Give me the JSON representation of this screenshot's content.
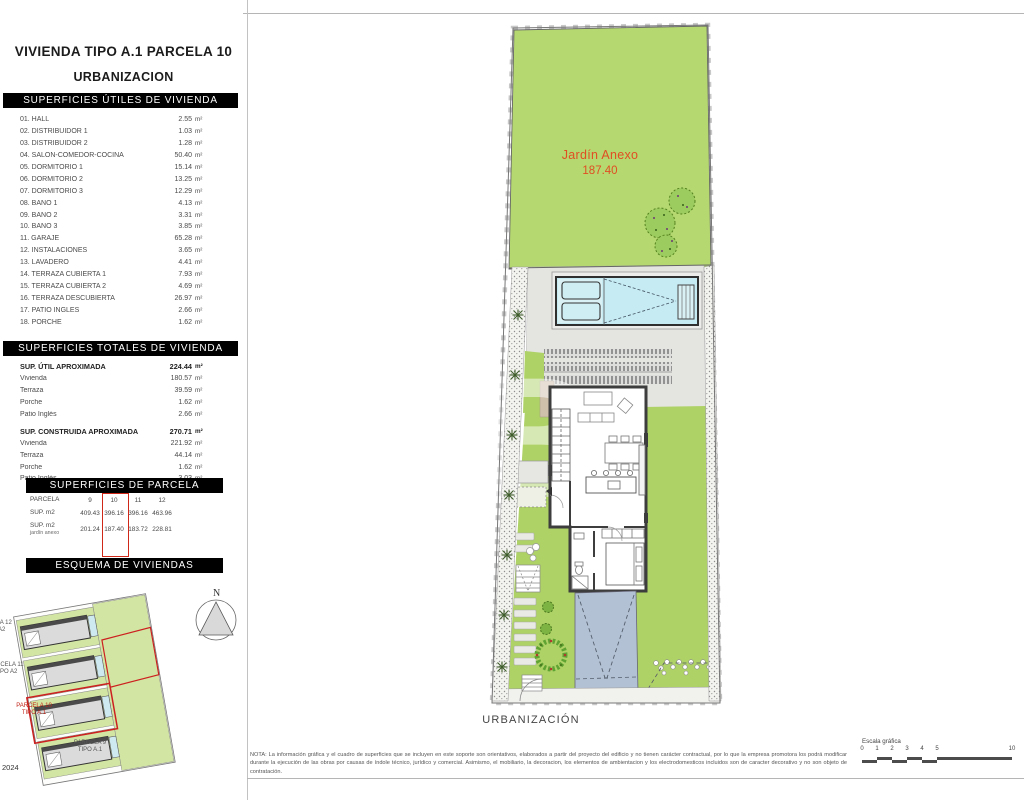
{
  "header": {
    "title_line1": "VIVIENDA TIPO A.1 PARCELA 10",
    "title_line2": "URBANIZACION"
  },
  "superficies_utiles": {
    "header": "SUPERFICIES ÚTILES DE VIVIENDA",
    "rows": [
      {
        "label": "01.  HALL",
        "value": "2.55",
        "unit": "m²"
      },
      {
        "label": "02.  DISTRIBUIDOR 1",
        "value": "1.03",
        "unit": "m²"
      },
      {
        "label": "03.  DISTRIBUIDOR 2",
        "value": "1.28",
        "unit": "m²"
      },
      {
        "label": "04.  SALÓN-COMEDOR-COCINA",
        "value": "50.40",
        "unit": "m²"
      },
      {
        "label": "05.  DORMITORIO 1",
        "value": "15.14",
        "unit": "m²"
      },
      {
        "label": "06.  DORMITORIO 2",
        "value": "13.25",
        "unit": "m²"
      },
      {
        "label": "07.  DORMITORIO 3",
        "value": "12.29",
        "unit": "m²"
      },
      {
        "label": "08.  BAÑO 1",
        "value": "4.13",
        "unit": "m²"
      },
      {
        "label": "09.  BAÑO 2",
        "value": "3.31",
        "unit": "m²"
      },
      {
        "label": "10.  BAÑO 3",
        "value": "3.85",
        "unit": "m²"
      },
      {
        "label": "11.  GARAJE",
        "value": "65.28",
        "unit": "m²"
      },
      {
        "label": "12.  INSTALACIONES",
        "value": "3.65",
        "unit": "m²"
      },
      {
        "label": "13.  LAVADERO",
        "value": "4.41",
        "unit": "m²"
      },
      {
        "label": "14.  TERRAZA CUBIERTA 1",
        "value": "7.93",
        "unit": "m²"
      },
      {
        "label": "15.  TERRAZA CUBIERTA 2",
        "value": "4.69",
        "unit": "m²"
      },
      {
        "label": "16.  TERRAZA DESCUBIERTA",
        "value": "26.97",
        "unit": "m²"
      },
      {
        "label": "17.  PATIO INGLES",
        "value": "2.66",
        "unit": "m²"
      },
      {
        "label": "18.  PORCHE",
        "value": "1.62",
        "unit": "m²"
      }
    ]
  },
  "superficies_totales": {
    "header": "SUPERFICIES TOTALES DE VIVIENDA",
    "groups": [
      {
        "title": "SUP. ÚTIL APROXIMADA",
        "total": "224.44",
        "unit": "m²",
        "rows": [
          {
            "label": "Vivienda",
            "value": "180.57",
            "unit": "m²"
          },
          {
            "label": "Terraza",
            "value": "39.59",
            "unit": "m²"
          },
          {
            "label": "Porche",
            "value": "1.62",
            "unit": "m²"
          },
          {
            "label": "Patio Inglés",
            "value": "2.66",
            "unit": "m²"
          }
        ]
      },
      {
        "title": "SUP. CONSTRUIDA APROXIMADA",
        "total": "270.71",
        "unit": "m²",
        "rows": [
          {
            "label": "Vivienda",
            "value": "221.92",
            "unit": "m²"
          },
          {
            "label": "Terraza",
            "value": "44.14",
            "unit": "m²"
          },
          {
            "label": "Porche",
            "value": "1.62",
            "unit": "m²"
          },
          {
            "label": "Patio Inglés",
            "value": "3.03",
            "unit": "m²"
          }
        ]
      }
    ]
  },
  "superficies_parcela": {
    "header": "SUPERFICIES DE PARCELA",
    "rows": [
      {
        "label": "PARCELA",
        "label2": "",
        "cells": [
          "9",
          "10",
          "11",
          "12"
        ]
      },
      {
        "label": "SUP. m2",
        "label2": "",
        "cells": [
          "409.43",
          "396.16",
          "396.16",
          "463.96"
        ]
      },
      {
        "label": "SUP. m2",
        "label2": "jardín anexo",
        "cells": [
          "201.24",
          "187.40",
          "183.72",
          "228.81"
        ]
      }
    ],
    "highlighted_column": "10"
  },
  "esquema": {
    "header": "ESQUEMA DE VIVIENDAS",
    "north_label": "N",
    "labels": [
      {
        "line1": "PARCELA 12",
        "line2": "TIPO A2"
      },
      {
        "line1": "PARCELA 11",
        "line2": "TIPO A2"
      },
      {
        "line1": "PARCELA 10",
        "line2": "TIPO A.1"
      },
      {
        "line1": "PARCELA 9",
        "line2": "TIPO A.1"
      }
    ],
    "year_label": "2024"
  },
  "plan": {
    "jardin_anexo_label": "Jardín Anexo",
    "jardin_anexo_value": "187.40",
    "caption": "URBANIZACIÓN",
    "watermark": "B"
  },
  "footer": {
    "nota": "NOTA: La información gráfica y el cuadro de superficies que se incluyen en este soporte son orientativos, elaborados a partir del proyecto del edificio y no tienen carácter contractual, por lo que la empresa promotora los podrá modificar durante la ejecución de las obras por causas de índole técnico, jurídico y comercial. Asimismo, el mobiliario, la decoracion, los elementos de ambientacion y los electrodomesticos incluidos son de caracter decorativo y no son objeto de contratación.",
    "escala_label": "Escala gráfica",
    "escala_ticks": [
      "0",
      "1",
      "2",
      "3",
      "4",
      "5",
      "10"
    ]
  },
  "colors": {
    "garden_green": "#aed266",
    "garden_green_light": "#b5d871",
    "pool_blue": "#c7ebf2",
    "driveway_blue": "#b3c1d4",
    "terrace_gray": "#e4e4e1",
    "wall_dark": "#3d3d3d",
    "accent_red": "#d02818",
    "label_orange": "#e04e22"
  }
}
